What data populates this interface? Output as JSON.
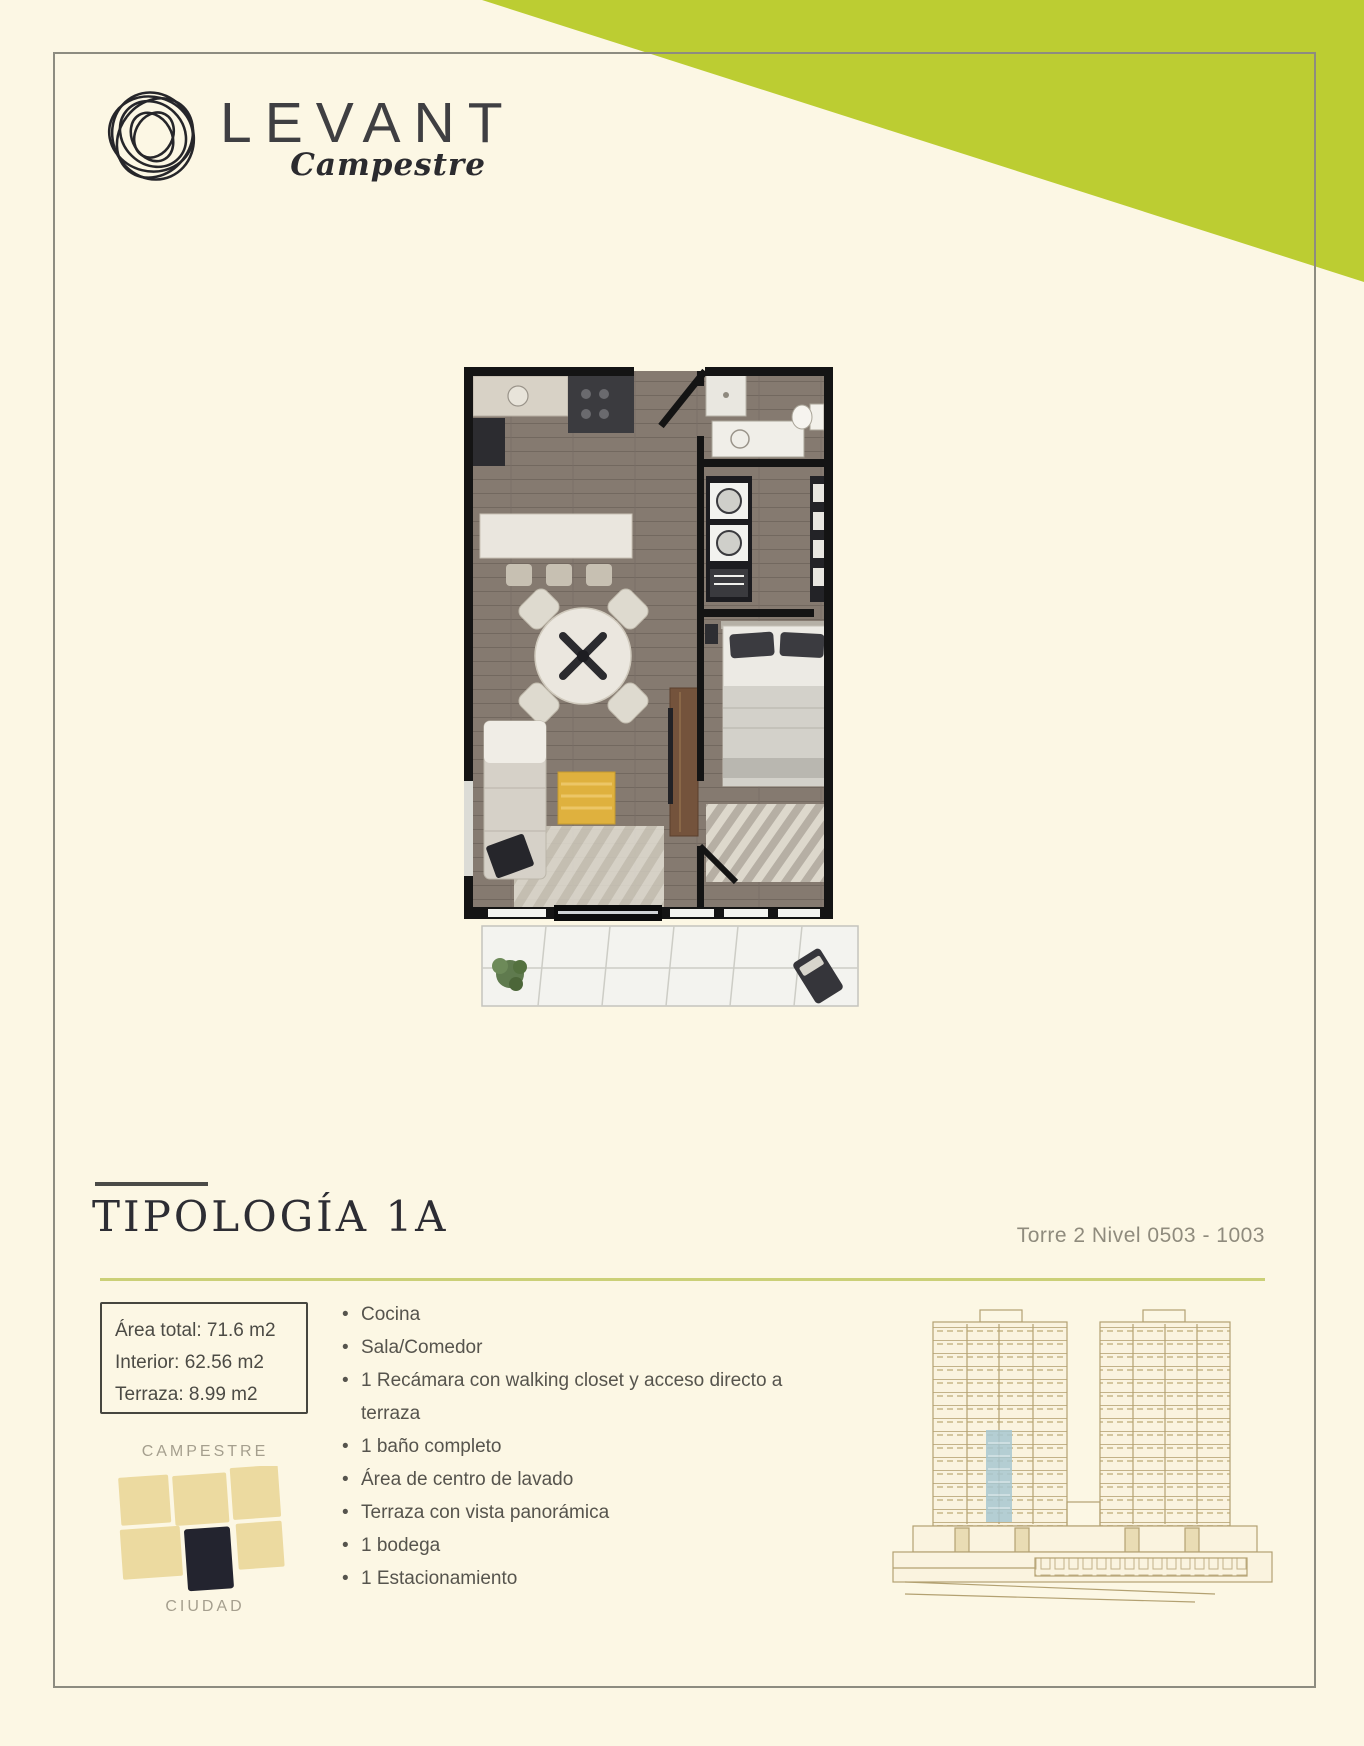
{
  "brand": {
    "name": "LEVANT",
    "subtitle": "Campestre"
  },
  "typology": {
    "title": "TIPOLOGÍA 1A",
    "tower_level": "Torre 2 Nivel 0503 - 1003"
  },
  "area_box": {
    "lines": [
      "Área total: 71.6 m2",
      "Interior: 62.56 m2",
      "Terraza: 8.99 m2"
    ]
  },
  "features": [
    "Cocina",
    "Sala/Comedor",
    "1 Recámara con walking closet y acceso directo a terraza",
    "1 baño completo",
    "Área de centro de lavado",
    "Terraza con vista panorámica",
    "1 bodega",
    "1 Estacionamiento"
  ],
  "location_key": {
    "top_label": "CAMPESTRE",
    "bottom_label": "CIUDAD"
  },
  "colors": {
    "page_background": "#fcf7e4",
    "accent_green": "#bccd32",
    "divider_green": "#cbd077",
    "card_border": "#8d8c80",
    "block_tan": "#ecdaa0",
    "block_navy": "#23242f",
    "elevation_line": "#b3a172",
    "elevation_highlight": "#a7c7d1"
  }
}
